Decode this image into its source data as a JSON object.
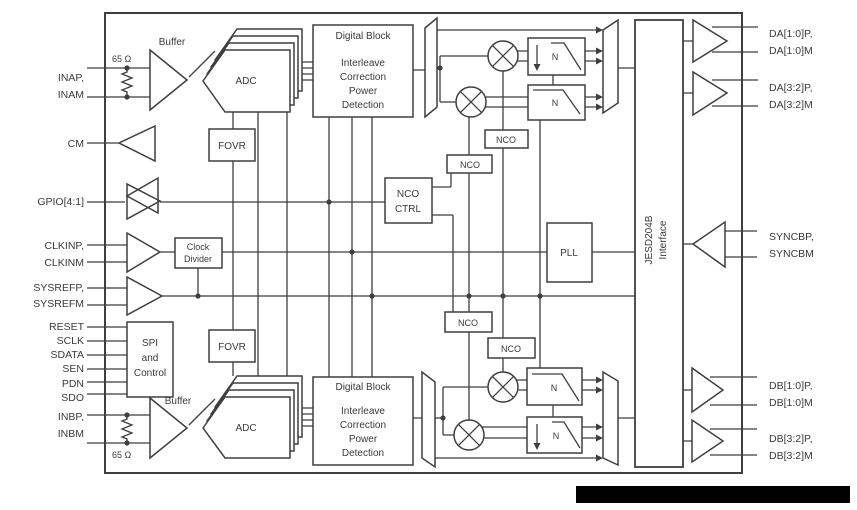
{
  "colors": {
    "line": "#3f3f3f",
    "text": "#3a3a3a",
    "background": "#ffffff",
    "redaction": "#000000"
  },
  "pins_left": {
    "inap": "INAP,",
    "inam": "INAM",
    "cm": "CM",
    "gpio": "GPIO[4:1]",
    "clkinp": "CLKINP,",
    "clkinm": "CLKINM",
    "sysrefp": "SYSREFP,",
    "sysrefm": "SYSREFM",
    "reset": "RESET",
    "sclk": "SCLK",
    "sdata": "SDATA",
    "sen": "SEN",
    "pdn": "PDN",
    "sdo": "SDO",
    "inbp": "INBP,",
    "inbm": "INBM"
  },
  "pins_right": {
    "da10p": "DA[1:0]P,",
    "da10m": "DA[1:0]M",
    "da32p": "DA[3:2]P,",
    "da32m": "DA[3:2]M",
    "syncbp": "SYNCBP,",
    "syncbm": "SYNCBM",
    "db10p": "DB[1:0]P,",
    "db10m": "DB[1:0]M",
    "db32p": "DB[3:2]P,",
    "db32m": "DB[3:2]M"
  },
  "labels": {
    "buffer": "Buffer",
    "adc": "ADC",
    "resistor": "65 Ω",
    "fovr": "FOVR",
    "nco": "NCO",
    "n": "N",
    "pll": "PLL",
    "digital_block": {
      "l1": "Digital Block",
      "l2": "Interleave",
      "l3": "Correction",
      "l4": "Power",
      "l5": "Detection"
    },
    "nco_ctrl": {
      "l1": "NCO",
      "l2": "CTRL"
    },
    "clock_divider": {
      "l1": "Clock",
      "l2": "Divider"
    },
    "spi": {
      "l1": "SPI",
      "l2": "and",
      "l3": "Control"
    },
    "jesd": {
      "l1": "JESD204B",
      "l2": "Interface"
    }
  }
}
